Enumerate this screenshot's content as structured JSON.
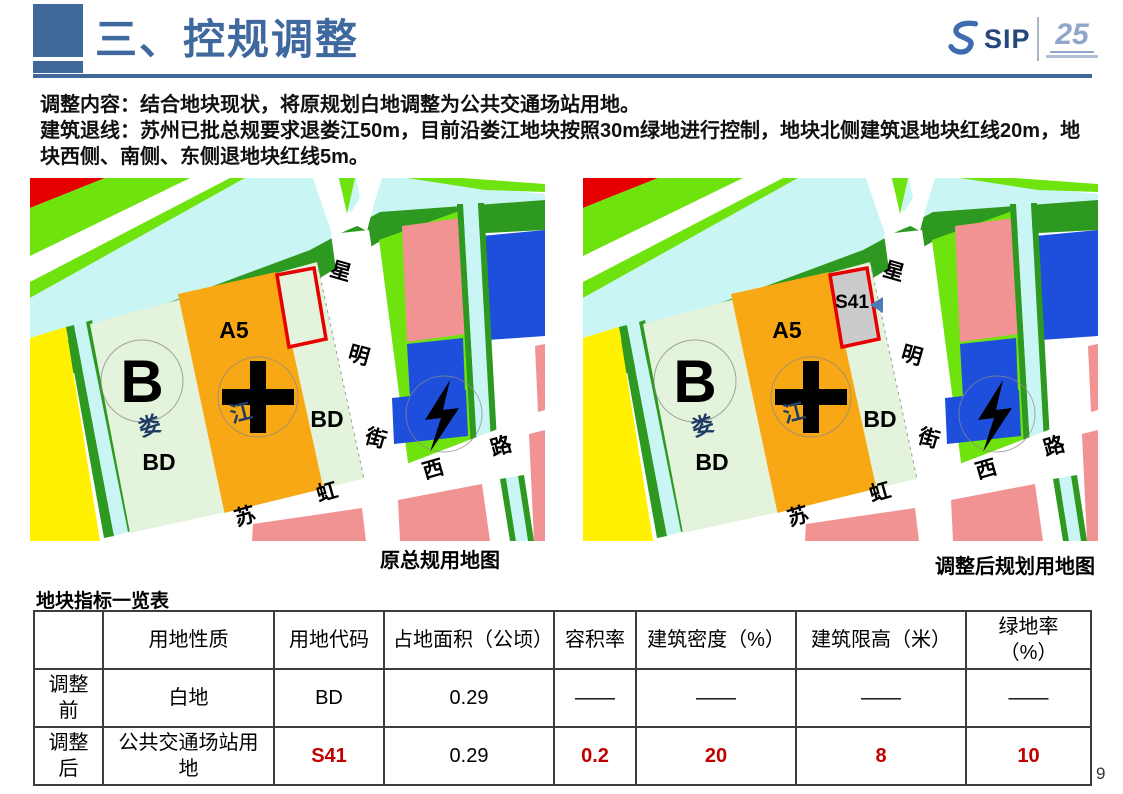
{
  "slide": {
    "title": "三、控规调整",
    "page_number": "9",
    "logo": {
      "sip": "SIP",
      "anniversary": "25"
    },
    "body": {
      "para1": "调整内容：结合地块现状，将原规划白地调整为公共交通场站用地。",
      "para2": "建筑退线：苏州已批总规要求退娄江50m，目前沿娄江地块按照30m绿地进行控制，地块北侧建筑退地块红线20m，地块西侧、南侧、东侧退地块红线5m。"
    },
    "maps": {
      "left_caption": "原总规用地图",
      "right_caption": "调整后规划用地图",
      "labels": {
        "river": [
          "娄",
          "江"
        ],
        "road_xingming": [
          "星",
          "明",
          "街"
        ],
        "road_suhong": [
          "苏",
          "虹",
          "西",
          "路"
        ],
        "parcel_b": "B",
        "parcel_a5": "A5",
        "parcel_bd_left": "BD",
        "parcel_bd_right": "BD",
        "plot_code": "S41"
      },
      "palette": {
        "bright_green": "#6FE30E",
        "dark_green": "#2E9920",
        "river_cyan": "#C9F6F4",
        "pale_green": "#E4F3DB",
        "orange": "#F8A815",
        "yellow": "#FFF100",
        "pink": "#F19293",
        "blue": "#1D4EDC",
        "plot_red": "#E80000",
        "plot_gray": "#CBCBCB",
        "label_navy": "#1E3C64",
        "marker_blue": "#4A7CB8"
      }
    },
    "table": {
      "title": "地块指标一览表",
      "headers": [
        "",
        "用地性质",
        "用地代码",
        "占地面积（公顷）",
        "容积率",
        "建筑密度（%）",
        "建筑限高（米）",
        "绿地率（%）"
      ],
      "col_widths": [
        69,
        171,
        110,
        170,
        82,
        160,
        170,
        125
      ],
      "rows": [
        {
          "label": "调整前",
          "cells": [
            {
              "text": "白地"
            },
            {
              "text": "BD"
            },
            {
              "text": "0.29"
            },
            {
              "text": "——"
            },
            {
              "text": "——"
            },
            {
              "text": "——"
            },
            {
              "text": "——"
            }
          ]
        },
        {
          "label": "调整后",
          "cells": [
            {
              "text": "公共交通场站用地"
            },
            {
              "text": "S41",
              "red": true
            },
            {
              "text": "0.29"
            },
            {
              "text": "0.2",
              "red": true
            },
            {
              "text": "20",
              "red": true
            },
            {
              "text": "8",
              "red": true
            },
            {
              "text": "10",
              "red": true
            }
          ]
        }
      ]
    },
    "accent_color": "#40689B",
    "value_red": "#C00000"
  }
}
